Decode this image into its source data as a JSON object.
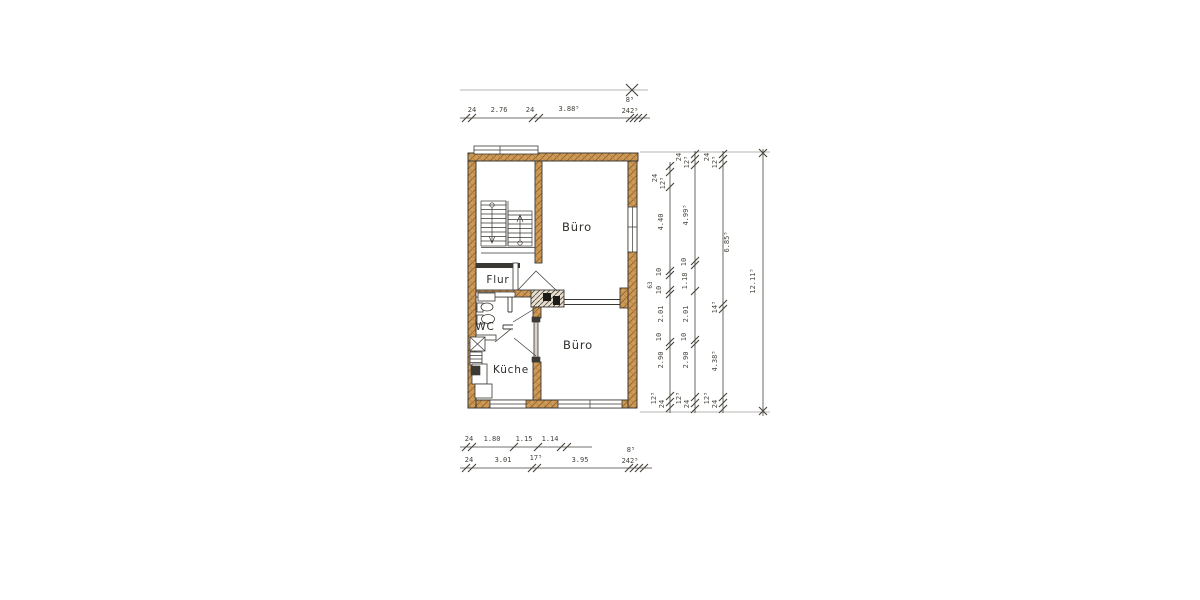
{
  "rooms": {
    "office_top": "Büro",
    "hall": "Flur",
    "wc": "WC",
    "kitchen": "Küche",
    "office_bottom": "Büro"
  },
  "dimensions": {
    "top": [
      "24",
      "2.76",
      "24",
      "3.88⁵",
      "8⁵",
      "242⁵"
    ],
    "bottom_upper": [
      "24",
      "1.80",
      "1.15",
      "1.14"
    ],
    "bottom_lower": [
      "24",
      "3.01",
      "17⁵",
      "3.95",
      "8⁵",
      "242⁵"
    ],
    "right_inner": [
      "24",
      "12⁵",
      "4.40",
      "10",
      "63",
      "10",
      "2.01",
      "10",
      "2.90",
      "12⁵",
      "24"
    ],
    "right_middle": [
      "24",
      "12⁵",
      "4.99⁵",
      "10",
      "1.18",
      "2.01",
      "10",
      "2.90",
      "12⁵",
      "24"
    ],
    "right_outer": [
      "24",
      "12⁵",
      "6.85⁵",
      "14⁵",
      "4.38⁵",
      "12⁵",
      "24"
    ],
    "right_total": [
      "12.11⁵"
    ]
  },
  "colors": {
    "wall_fill": "#cf9a55",
    "ink": "#3a3833",
    "dim_ink": "#45423b",
    "paper": "#ffffff"
  }
}
